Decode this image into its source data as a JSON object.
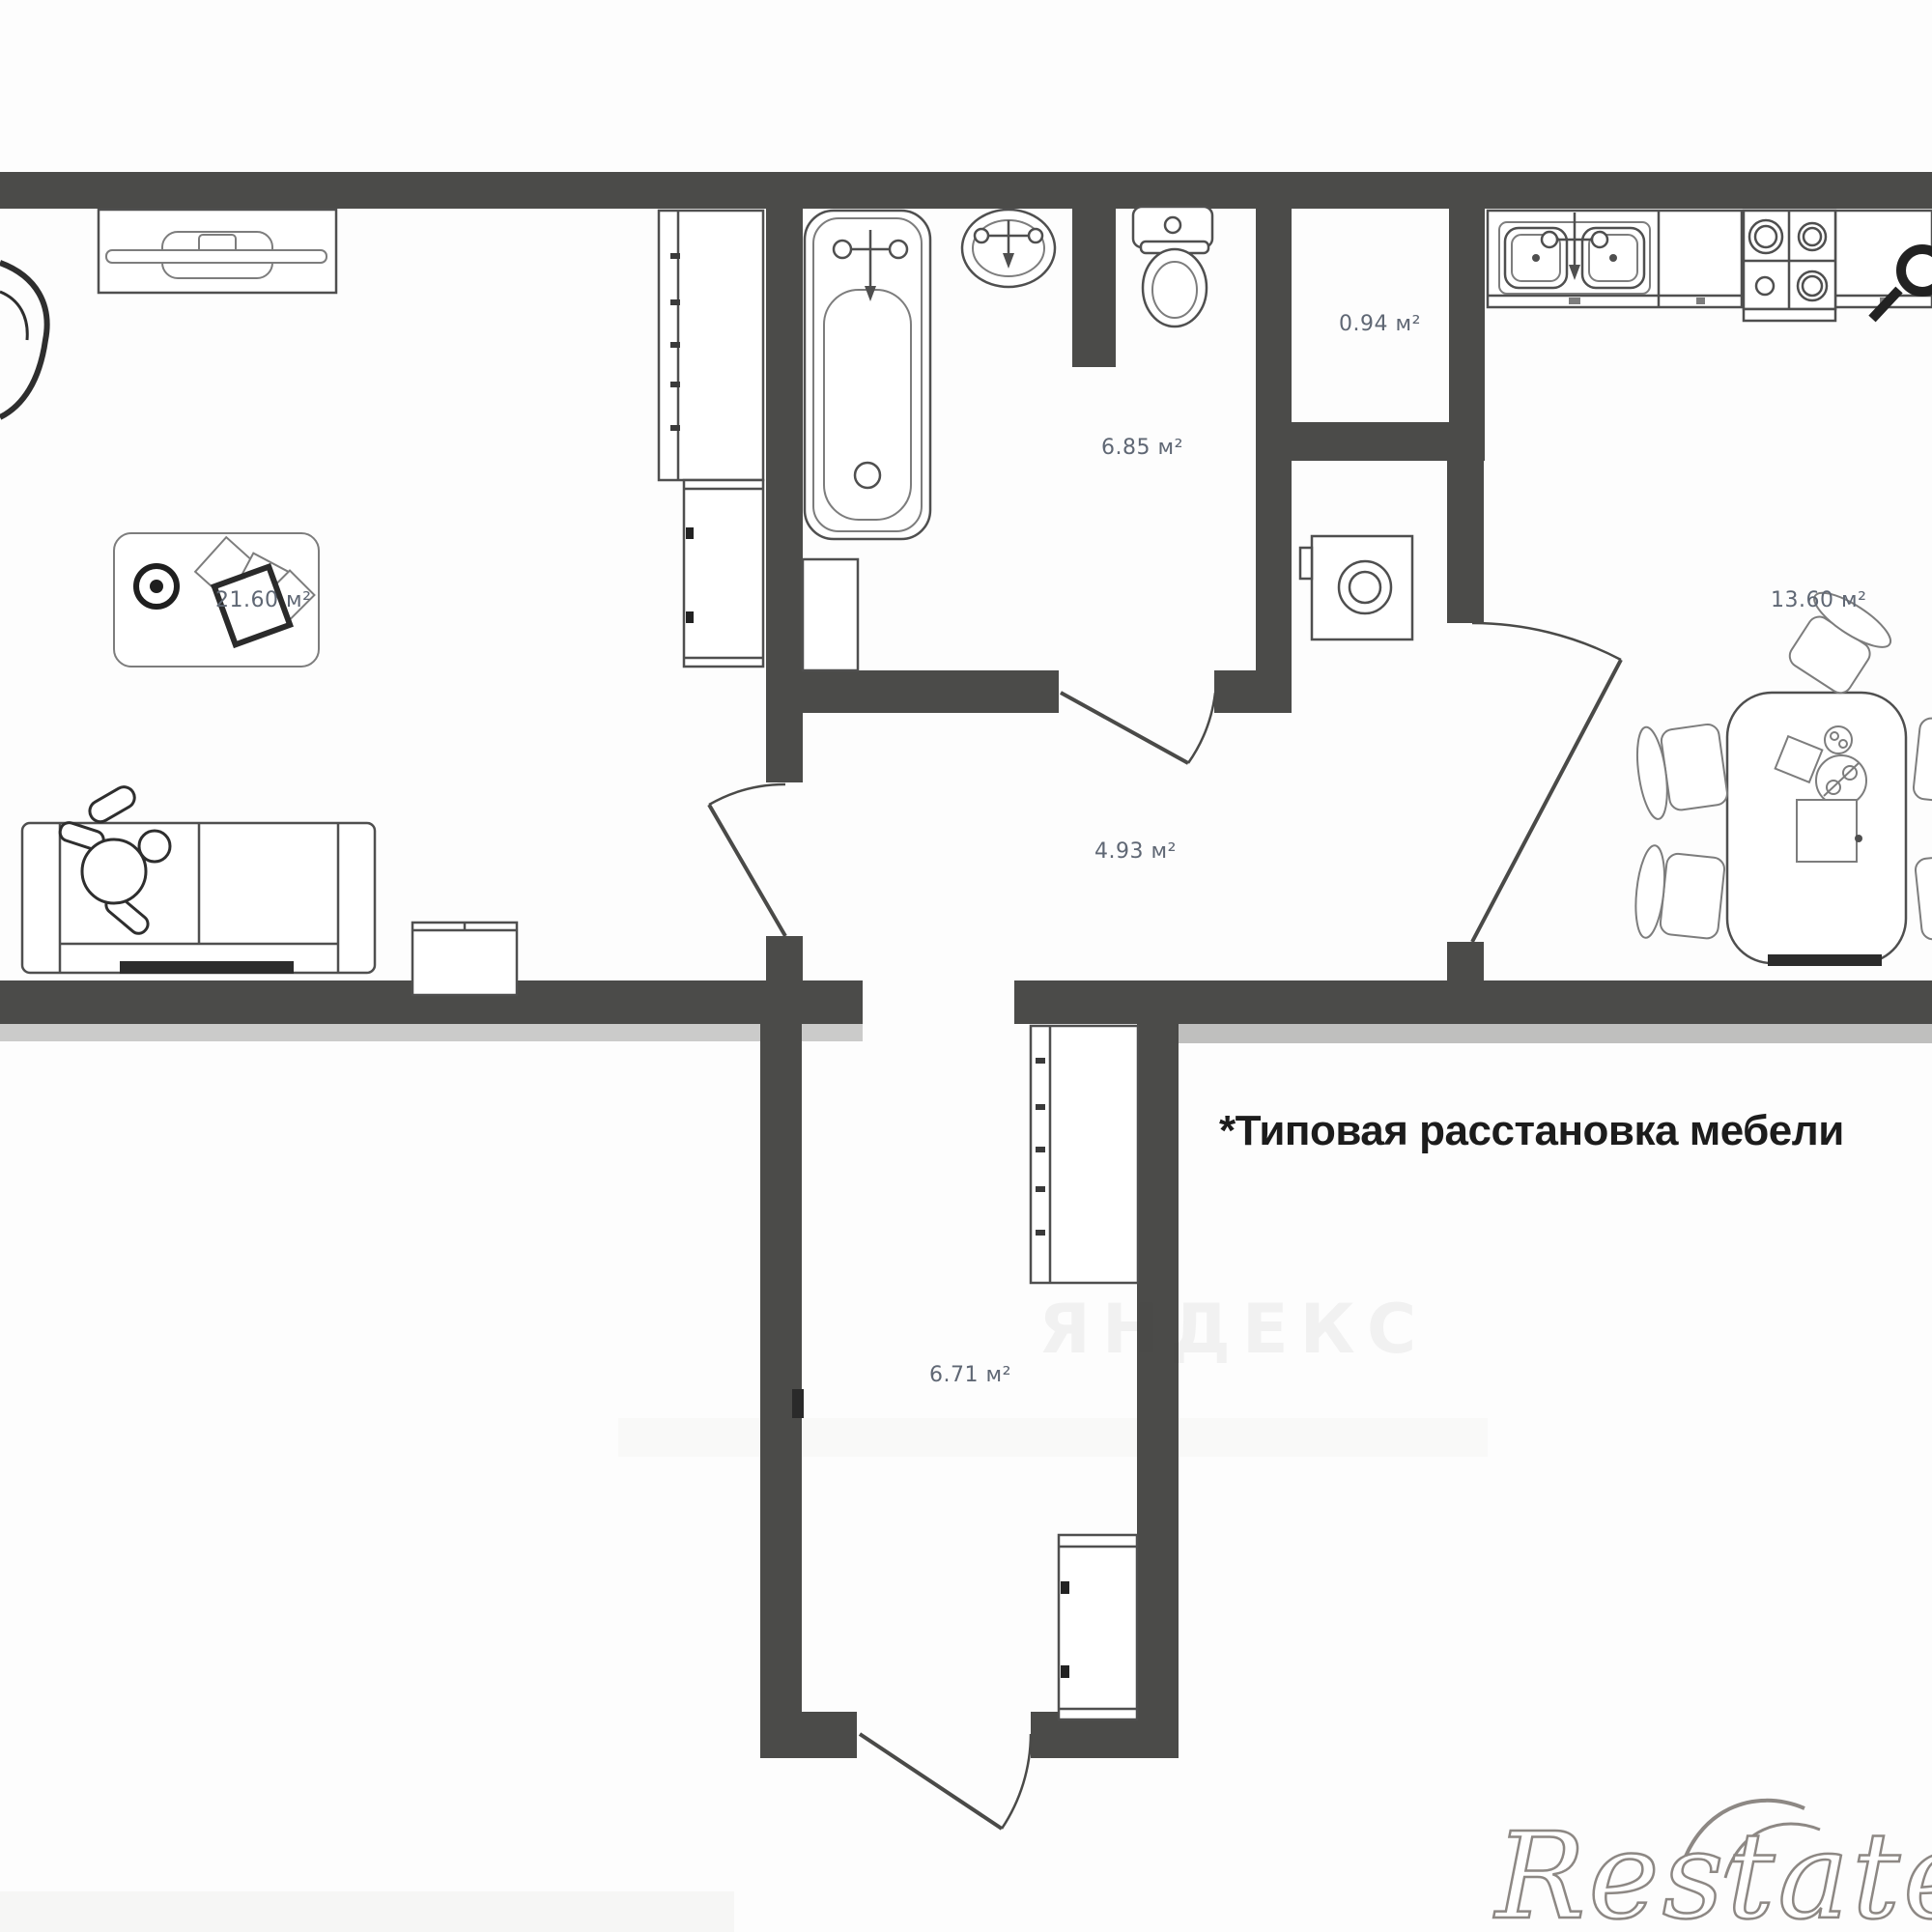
{
  "floor_plan": {
    "note": "*Типовая расстановка мебели",
    "watermark": "Restate",
    "watermark_faint": "ЯНДЕКС",
    "unit": "м²",
    "rooms": [
      {
        "id": "living-room",
        "label": "21.60 м²"
      },
      {
        "id": "bathroom",
        "label": "6.85 м²"
      },
      {
        "id": "storage",
        "label": "0.94 м²"
      },
      {
        "id": "hallway",
        "label": "4.93 м²"
      },
      {
        "id": "kitchen",
        "label": "13.60 м²"
      },
      {
        "id": "corridor",
        "label": "6.71 м²"
      }
    ],
    "colors": {
      "wall": "#4b4b49",
      "furniture_line": "#4f4f4f",
      "label_text": "#5f6774",
      "note_text": "#1c1c1c"
    }
  }
}
